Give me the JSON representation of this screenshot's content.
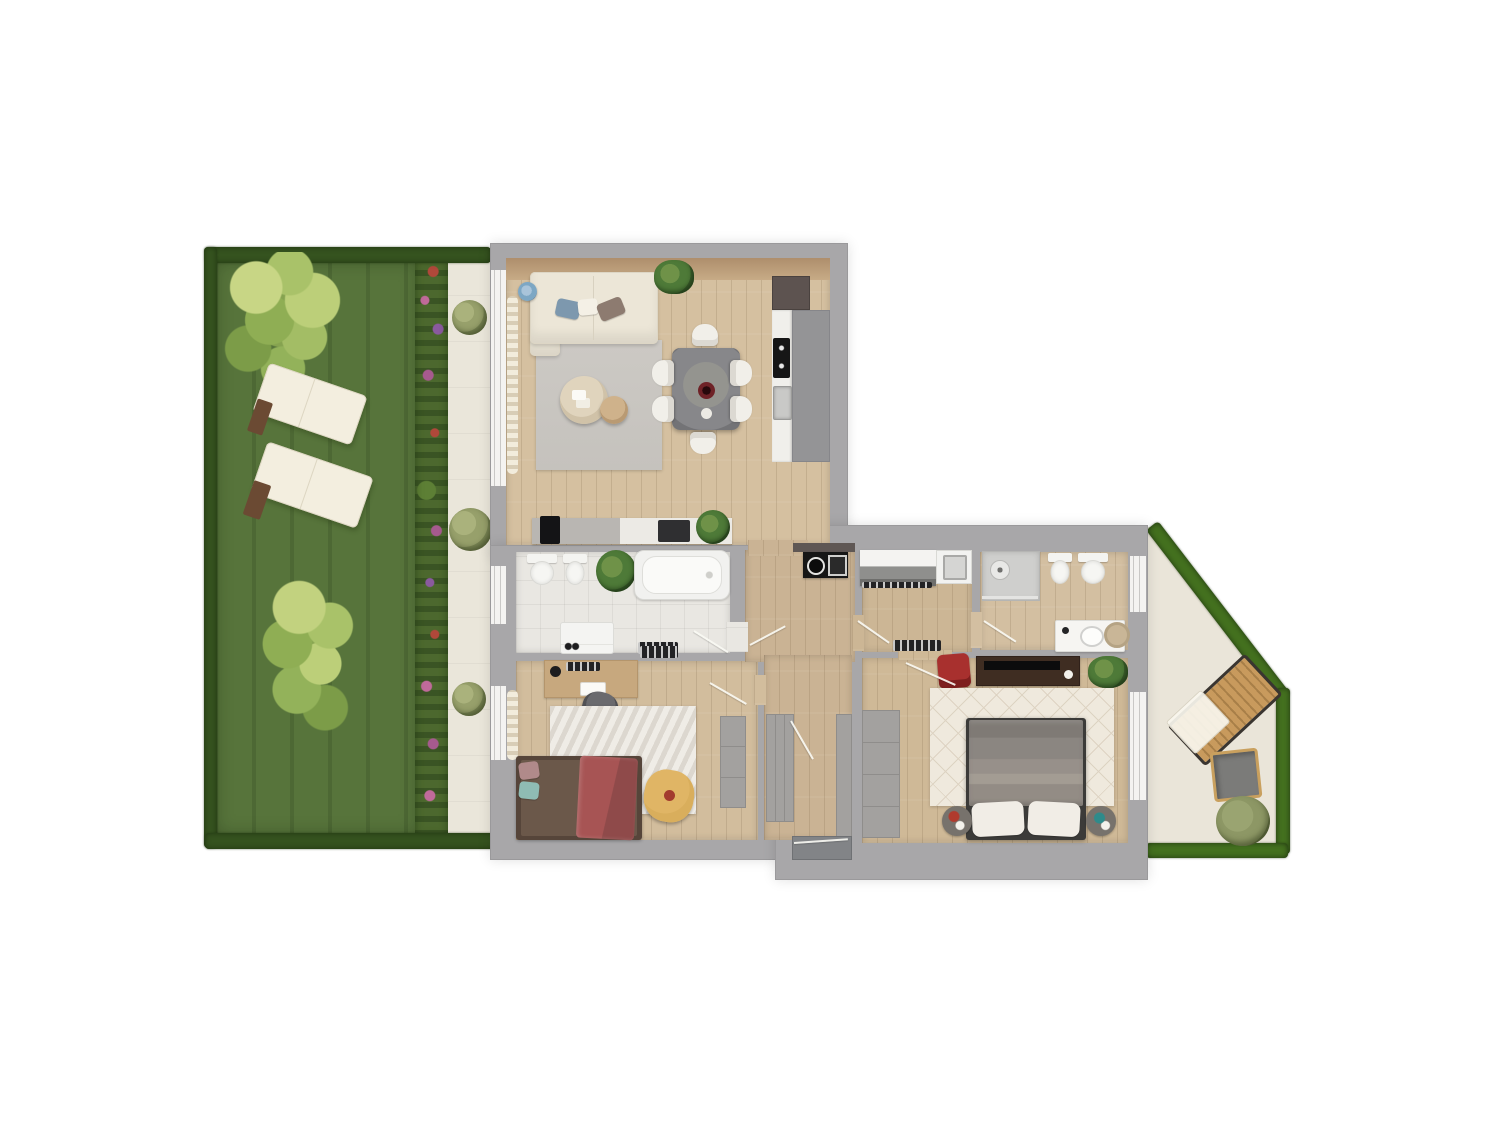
{
  "meta": {
    "scene": "3d-floor-plan-render-top-view",
    "render_style": "photoreal top-down apartment plan with garden and terrace, no text labels visible"
  },
  "colors": {
    "background": "#ffffff",
    "wall": "#a8a7a9",
    "wall_dark": "#8a8a8d",
    "wood_living": "#d5c0a0",
    "wood_corridor": "#cab394",
    "wood_bed2": "#d2bd9d",
    "wood_master": "#cfb997",
    "wood_bath2": "#d3bfa1",
    "wood_utility": "#ccb695",
    "tile": "#e9e7e2",
    "grass": "#57743b",
    "hedge": "#35531f",
    "hedge_bright": "#44711f",
    "path": "#eae6da",
    "terrace": "#eae5d9",
    "rug_gray": "#cac7c2",
    "rug_chevron": "#efece6",
    "rug_diamond": "#efe9dd",
    "sofa_cream": "#ece6d7",
    "dining_gray": "#87878a",
    "kitchen_black": "#161616",
    "counter_white": "#f0efeb",
    "accent_red": "#a8302e",
    "blanket_red": "#a75454",
    "pouf_yellow": "#d9ae5c",
    "bed_gray": "#8b8681",
    "plant_green": "#4e7a38",
    "window_white": "#f4f3f1",
    "lounger_cream": "#f3eedf",
    "lounger_wood": "#6b4a33",
    "terrace_wood": "#c89a5d"
  },
  "apartment": {
    "rooms": [
      {
        "name": "living-room-with-kitchenette"
      },
      {
        "name": "family-bathroom"
      },
      {
        "name": "second-bedroom-office"
      },
      {
        "name": "hallway"
      },
      {
        "name": "entry-vestibule"
      },
      {
        "name": "utility-kitchen-room"
      },
      {
        "name": "ensuite-shower-bathroom"
      },
      {
        "name": "master-bedroom"
      }
    ],
    "furniture": [
      "corner-sofa",
      "floor-lamp",
      "coffee-tables",
      "dining-table-six-chairs",
      "kitchen-counter-cooktop-sink",
      "tall-cabinet",
      "media-lowboard",
      "toilet",
      "bidet",
      "bathtub",
      "washing-machine",
      "desk-with-shelf",
      "desk-chair",
      "single-bed",
      "pouf",
      "wardrobe",
      "hall-closets",
      "laundry-counter-sink",
      "shower",
      "vanity",
      "double-bed",
      "nightstands",
      "tv-console",
      "red-armchair"
    ]
  },
  "outdoor": {
    "areas": [
      {
        "name": "lawn-garden-with-hedge"
      },
      {
        "name": "flower-border"
      },
      {
        "name": "paved-path"
      },
      {
        "name": "terrace-patio"
      }
    ],
    "items": [
      "deciduous-tree",
      "sun-loungers",
      "round-bushes",
      "wooden-deck-lounger",
      "patio-armchair",
      "patio-shrub"
    ]
  }
}
